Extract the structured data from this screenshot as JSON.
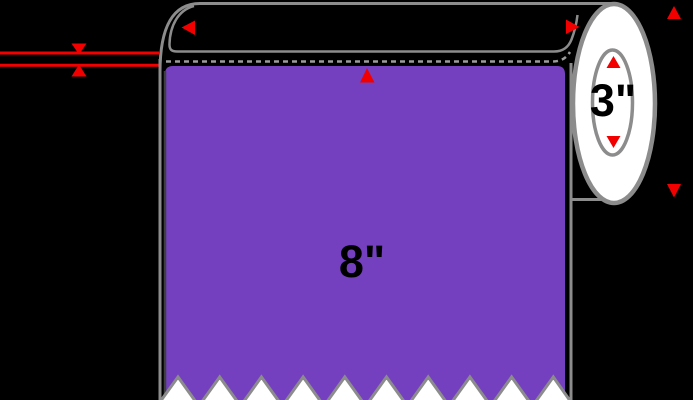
{
  "diagram": {
    "label_width_text": "8\"",
    "core_diameter_text": "3\""
  },
  "colors": {
    "label_purple": "#7440C0",
    "arrow_red": "#F20000",
    "outline_gray": "#8C8C8C",
    "dashed_gray": "#9C9C9C",
    "shadow_dark": "#3F3F3F",
    "end_cap_white": "#FFFFFF",
    "text_black": "#000000",
    "background": "#000000"
  }
}
